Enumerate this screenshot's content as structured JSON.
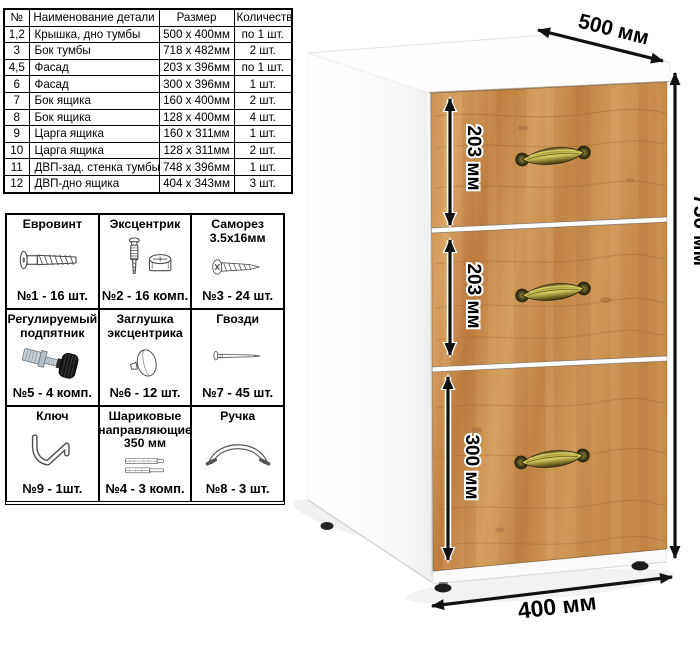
{
  "parts_table": {
    "headers": [
      "№",
      "Наименование детали",
      "Размер",
      "Количество"
    ],
    "rows": [
      [
        "1,2",
        "Крышка, дно тумбы",
        "500 х 400мм",
        "по 1 шт."
      ],
      [
        "3",
        "Бок тумбы",
        "718 х 482мм",
        "2 шт."
      ],
      [
        "4,5",
        "Фасад",
        "203 х 396мм",
        "по 1 шт."
      ],
      [
        "6",
        "Фасад",
        "300 х 396мм",
        "1 шт."
      ],
      [
        "7",
        "Бок ящика",
        "160 х 400мм",
        "2 шт."
      ],
      [
        "8",
        "Бок ящика",
        "128 х 400мм",
        "4 шт."
      ],
      [
        "9",
        "Царга ящика",
        "160 х 311мм",
        "1 шт."
      ],
      [
        "10",
        "Царга ящика",
        "128 х 311мм",
        "2 шт."
      ],
      [
        "11",
        "ДВП-зад. стенка тумбы",
        "748 х 396мм",
        "1 шт."
      ],
      [
        "12",
        "ДВП-дно ящика",
        "404 х 343мм",
        "3 шт."
      ]
    ]
  },
  "hardware": {
    "items": [
      {
        "title": "Евровинт",
        "count": "№1 - 16 шт.",
        "icon": "euro-screw"
      },
      {
        "title": "Эксцентрик",
        "count": "№2 - 16 комп.",
        "icon": "cam-lock"
      },
      {
        "title": "Саморез 3.5х16мм",
        "count": "№3 - 24 шт.",
        "icon": "self-tapping-screw"
      },
      {
        "title": "Регулируемый подпятник",
        "count": "№5 - 4 комп.",
        "icon": "adjustable-foot"
      },
      {
        "title": "Заглушка эксцентрика",
        "count": "№6 - 12 шт.",
        "icon": "cam-cover"
      },
      {
        "title": "Гвозди",
        "count": "№7 - 45 шт.",
        "icon": "nail"
      },
      {
        "title": "Ключ",
        "count": "№9 - 1шт.",
        "icon": "hex-key"
      },
      {
        "title": "Шариковые направляющие 350 мм",
        "count": "№4 - 3 комп.",
        "icon": "ball-slides"
      },
      {
        "title": "Ручка",
        "count": "№8 - 3 шт.",
        "icon": "handle"
      }
    ]
  },
  "cabinet": {
    "dimensions": {
      "depth": "500 мм",
      "height": "750 мм",
      "width": "400 мм",
      "drawers": [
        "203 мм",
        "203 мм",
        "300 мм"
      ]
    },
    "colors": {
      "wood_mid": "#c98f4e",
      "wood_dark": "#a86a34",
      "handle_brass": "#a6983e",
      "body_white": "#ffffff",
      "arrow_black": "#111111"
    }
  }
}
